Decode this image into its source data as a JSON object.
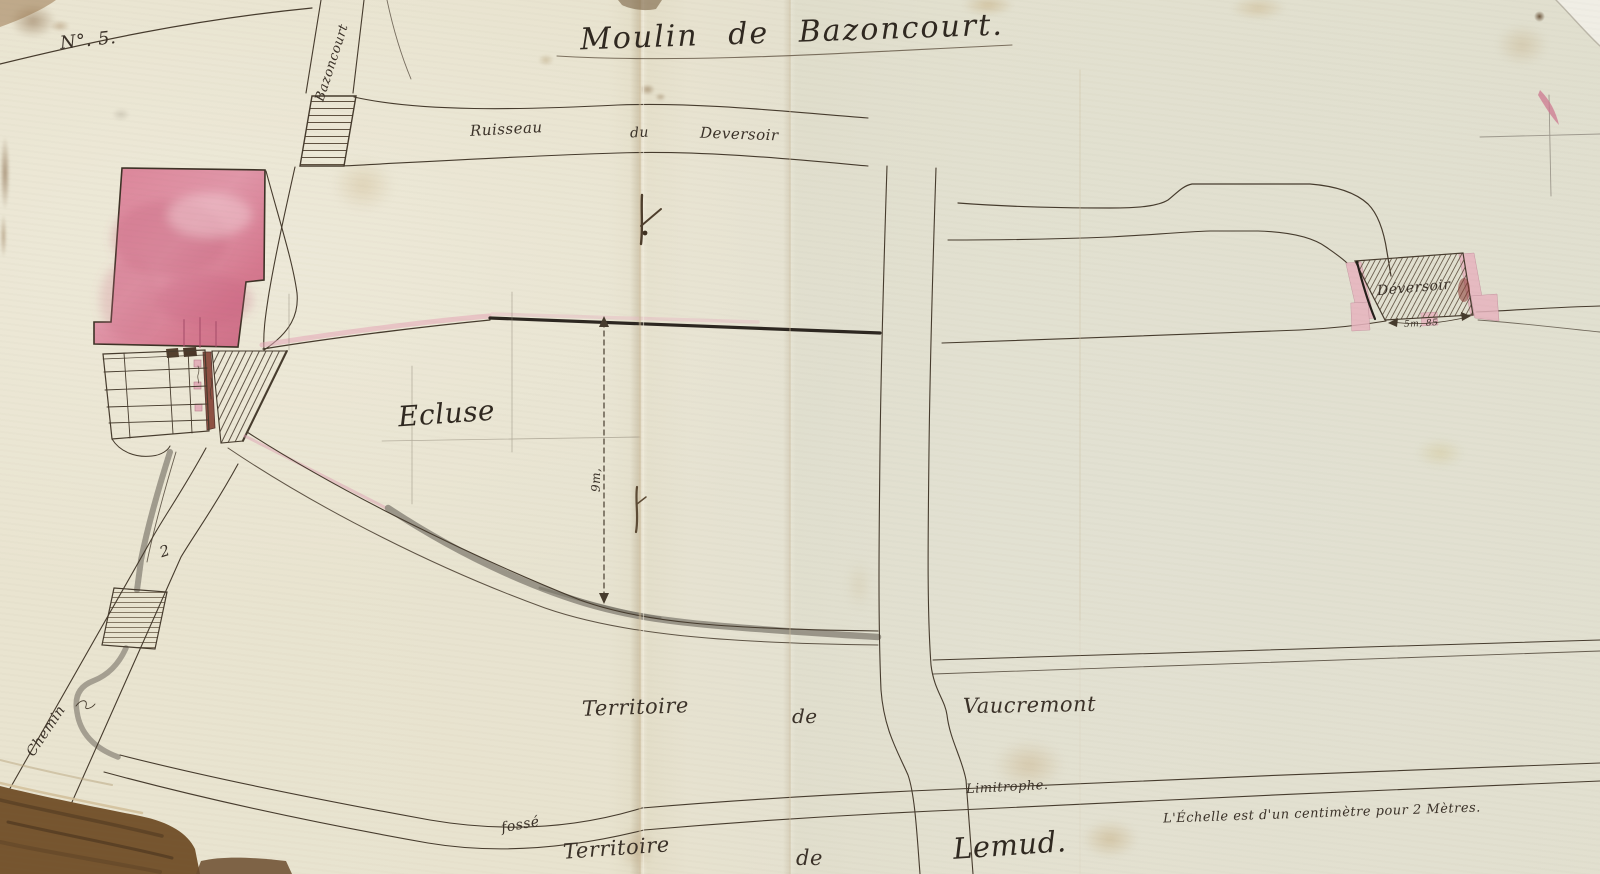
{
  "plan": {
    "number": "N°. 5.",
    "title": "Moulin de Bazoncourt.",
    "scale_note": "L'Échelle est d'un centimètre pour 2 Mètres."
  },
  "labels": {
    "road_bazoncourt": "Bazoncourt",
    "stream_word_1": "Ruisseau",
    "stream_word_2": "du",
    "stream_word_3": "Deversoir",
    "ecluse": "Ecluse",
    "dimension_9m": "9m,",
    "weir_name": "Déversoir",
    "weir_width": "5m, 85",
    "territory_word_1": "Territoire",
    "territory_word_2": "de",
    "territory_vaucremont": "Vaucremont",
    "limitrophe": "Limitrophe.",
    "fosse": "fossé",
    "territory2_word_1": "Territoire",
    "territory2_word_2": "de",
    "territory_lemud": "Lemud.",
    "road_chemin": "Chemin",
    "figure_2": "2"
  },
  "colors": {
    "paper": "#e7e3d1",
    "ink": "#463b2d",
    "building_wash": "#d5798f",
    "water_wash": "#8d887c",
    "pink_wash": "#e7b4bf"
  }
}
